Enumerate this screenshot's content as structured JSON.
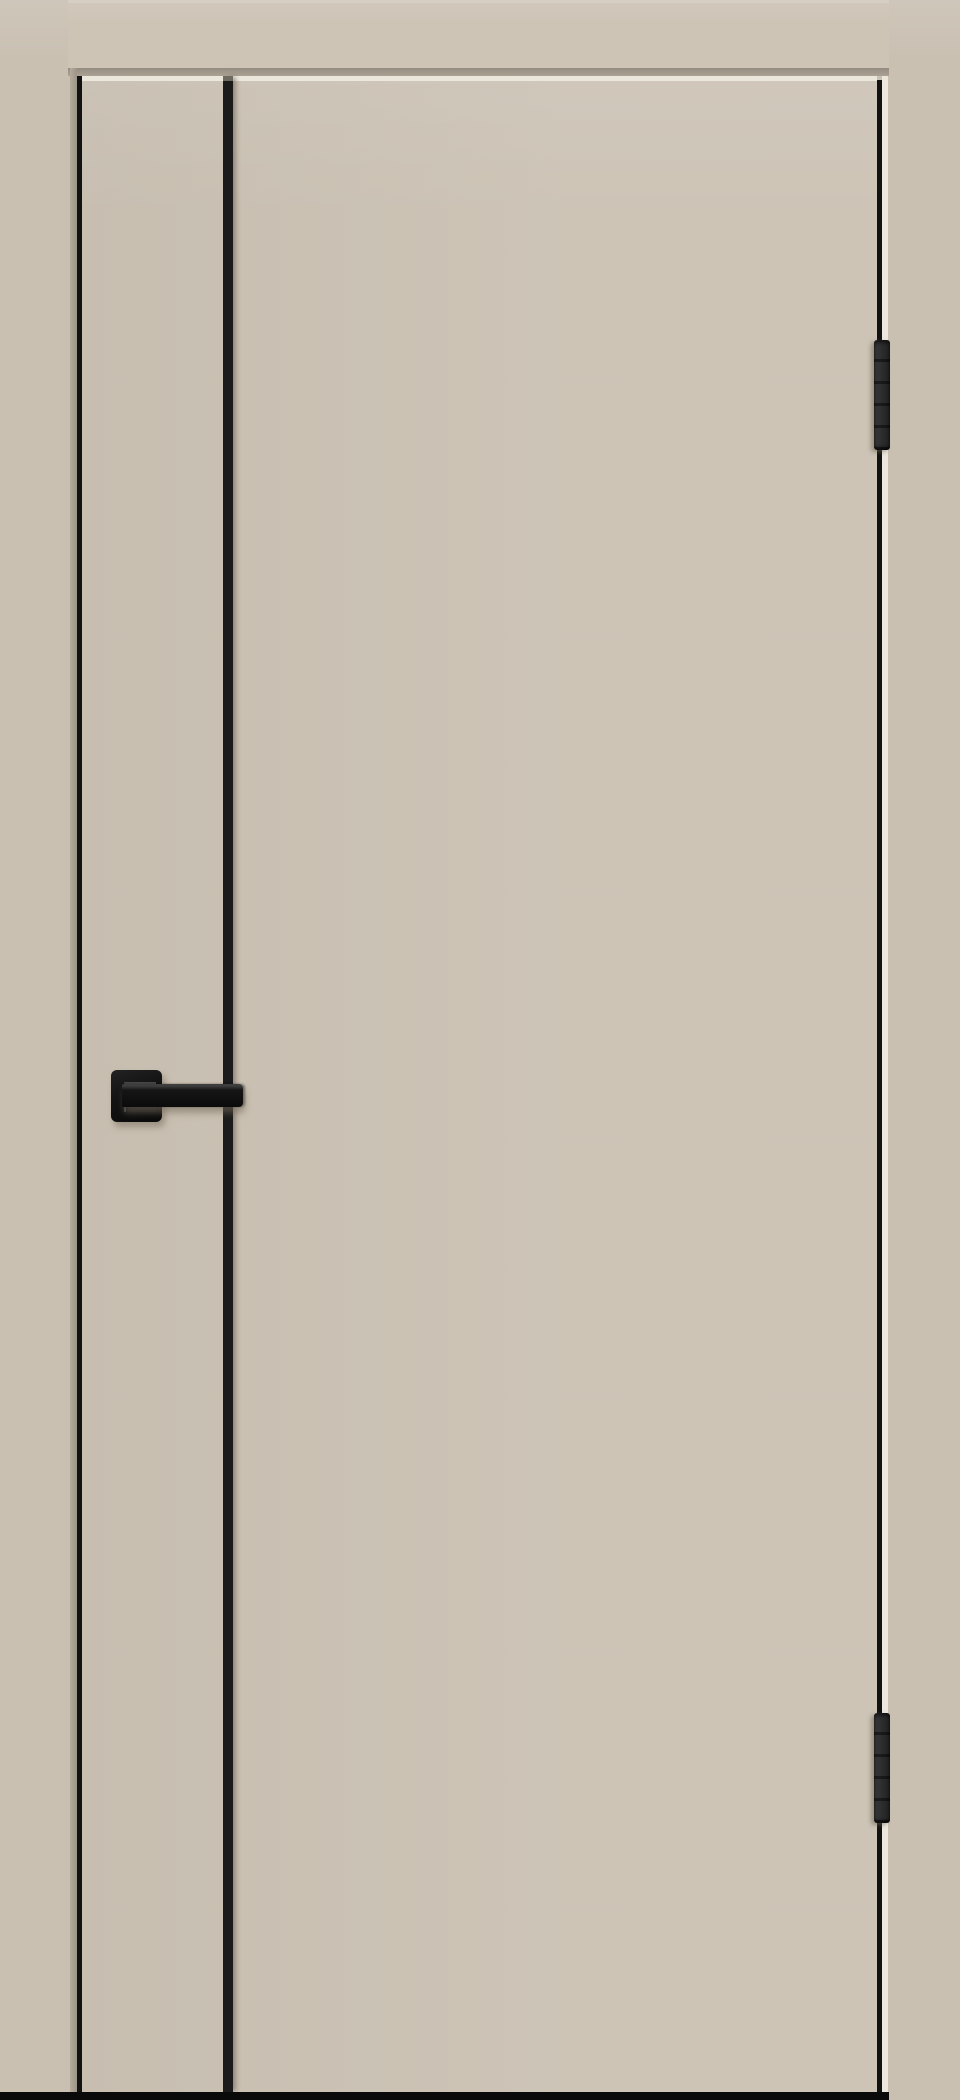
{
  "scene": {
    "subject": "interior-door-product-photo",
    "door": {
      "leaf_style": "flush single-panel leaf",
      "finish_color_name": "beige / magnolia matte",
      "molding": {
        "type": "vertical black aluminum strip",
        "count": 1,
        "position": "left third of leaf, full height"
      },
      "handle": {
        "type": "lever handle on square rosette",
        "color_name": "matte black",
        "side": "left"
      },
      "hinges": {
        "type": "concealed barrel end hinges",
        "count": 2,
        "color_name": "black",
        "side": "right edge"
      }
    }
  },
  "colors": {
    "wall": "#c9c0b2",
    "casing": "#cdc4b6",
    "casing_shadow": "#9e968a",
    "jamb_shadow": "#a59c8f",
    "door_leaf": "#cbc2b4",
    "gap_highlight": "#ece7dd",
    "edge_black": "#121212",
    "molding_strip": "#1b1b1b",
    "hinge_gray": "#2e2e2e",
    "hardware_black": "#0e0e0e",
    "bottom_gap": "#0a0a0a"
  }
}
